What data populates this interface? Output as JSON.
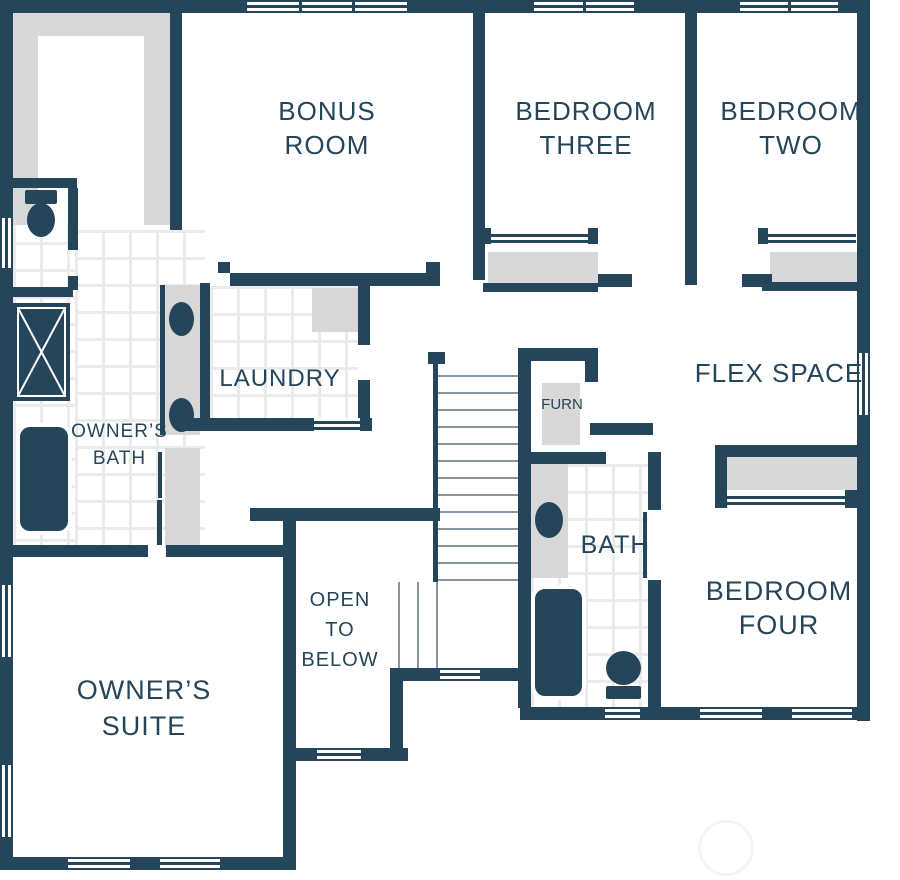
{
  "plan": {
    "type": "second-floor-plan",
    "colors": {
      "wall": "#24455a",
      "fill": "#d8d8d8",
      "tile_line": "#ebebeb",
      "tread": "#8796a2",
      "background": "#ffffff",
      "watermark": "#f4f4f4"
    },
    "rooms": {
      "bonus_room": {
        "label": "BONUS\nROOM"
      },
      "bedroom_three": {
        "label": "BEDROOM\nTHREE"
      },
      "bedroom_two": {
        "label": "BEDROOM\nTWO"
      },
      "owners_bath": {
        "label": "OWNER’S\nBATH"
      },
      "laundry": {
        "label": "LAUNDRY"
      },
      "furnace": {
        "label": "FURN"
      },
      "flex_space": {
        "label": "FLEX SPACE"
      },
      "bath": {
        "label": "BATH"
      },
      "open_to_below": {
        "label": "OPEN\nTO\nBELOW"
      },
      "bedroom_four": {
        "label": "BEDROOM\nFOUR"
      },
      "owners_suite": {
        "label": "OWNER’S\nSUITE"
      }
    },
    "fixtures": [
      "walk-in-closet",
      "toilet",
      "shower",
      "bathtub",
      "double-vanity",
      "sink",
      "linen-closet",
      "washer-dryer",
      "furnace-closet",
      "stairs",
      "railing",
      "sliding-closet-door",
      "window"
    ]
  }
}
